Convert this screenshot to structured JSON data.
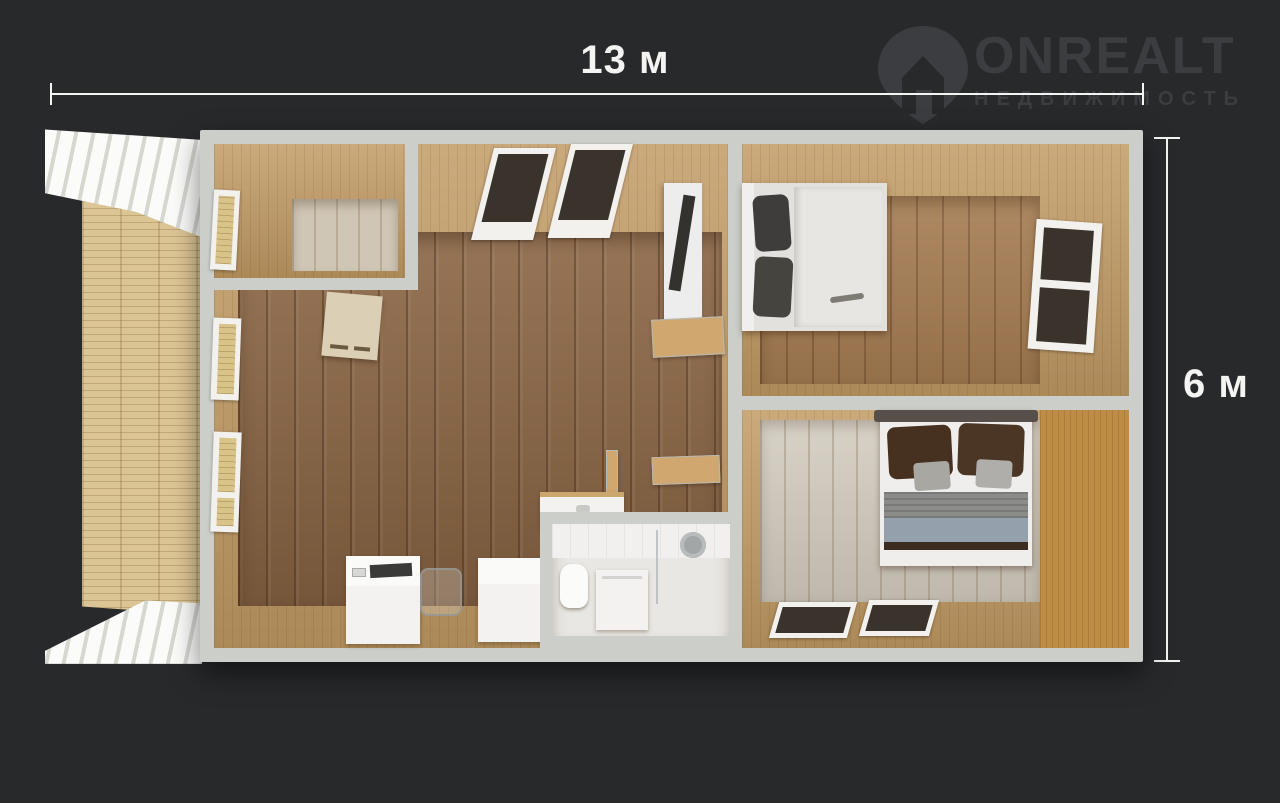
{
  "dimensions": {
    "width_label": "13 м",
    "height_label": "6 м"
  },
  "logo": {
    "title": "ONREALT",
    "subtitle": "НЕДВИЖИМОСТЬ"
  },
  "colors": {
    "background": "#28292b",
    "dimension_line": "#f4f4f3",
    "watermark": "#3b3d40",
    "wall": "#cbcec9",
    "interior_wood": "#c09962",
    "terrace_wood": "#dcc595",
    "living_floor": "#8a6544",
    "bedroom_top_floor": "#a57c52",
    "bedroom_bottom_floor": "#cfc8bb",
    "entry_floor": "#d0c6b5",
    "bathroom_floor": "#d8d4cf"
  },
  "elements": [
    "pergola-slats-top",
    "terrace-deck",
    "pergola-slats-bottom",
    "entry-room",
    "living-kitchen-room",
    "bathroom",
    "bedroom-top-right",
    "bedroom-bottom-right",
    "double-bed",
    "tv-panel",
    "wall-shelf",
    "kitchen-counter",
    "ghost-chair",
    "sink-counter",
    "toilet",
    "washing-machine",
    "shower-head",
    "window"
  ]
}
